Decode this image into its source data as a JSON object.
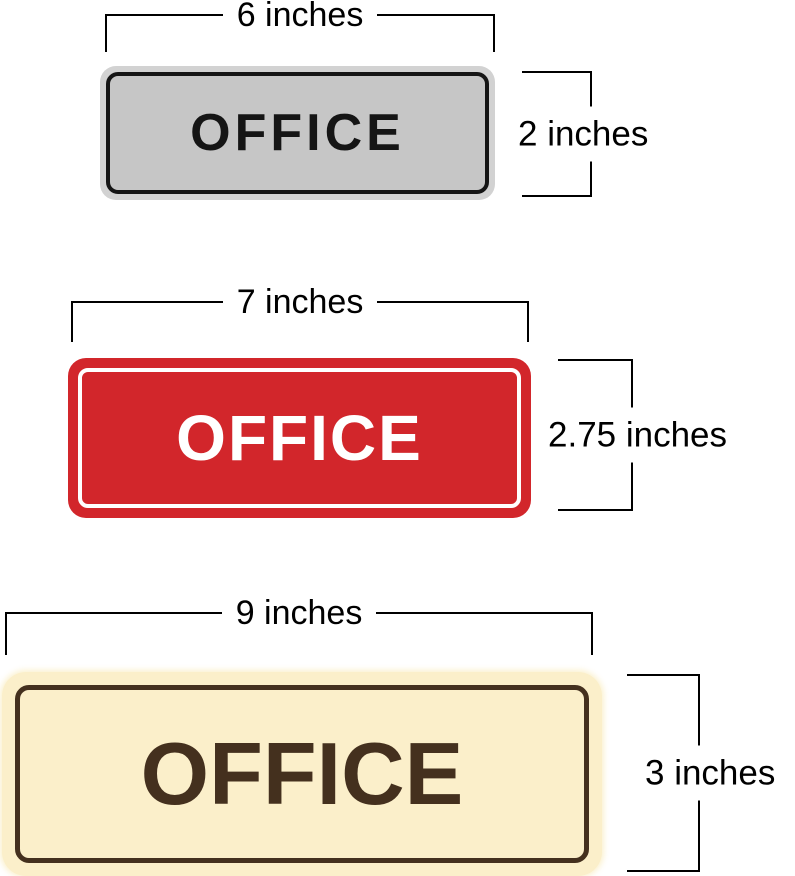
{
  "page": {
    "background_color": "#ffffff",
    "dimension_line_color": "#000000"
  },
  "signs": [
    {
      "name": "gray-office-sign",
      "label": "OFFICE",
      "width_label": "6 inches",
      "height_label": "2 inches",
      "colors": {
        "frame": "#d2d2d2",
        "face": "#c6c6c6",
        "border": "#151515",
        "text": "#151515"
      }
    },
    {
      "name": "red-office-sign",
      "label": "OFFICE",
      "width_label": "7 inches",
      "height_label": "2.75 inches",
      "colors": {
        "face": "#d2262b",
        "inner_border": "#ffffff",
        "text": "#ffffff"
      }
    },
    {
      "name": "cream-office-sign",
      "label": "OFFICE",
      "width_label": "9 inches",
      "height_label": "3 inches",
      "colors": {
        "face": "#fbefca",
        "border": "#44301e",
        "text": "#44301e"
      }
    }
  ]
}
